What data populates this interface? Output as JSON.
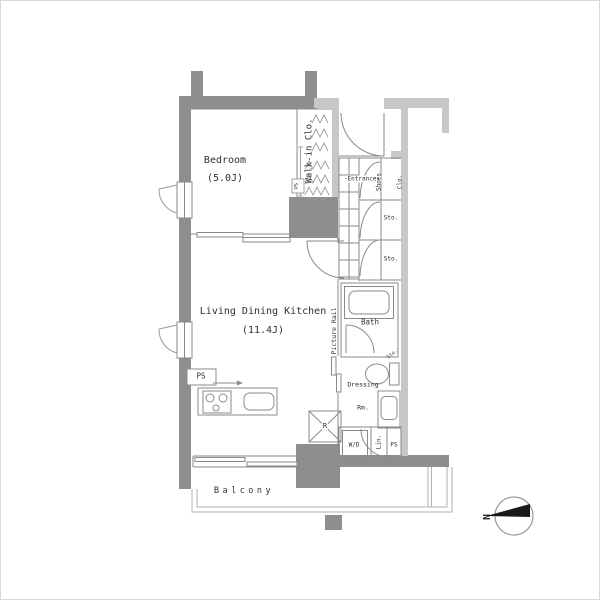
{
  "colors": {
    "wall_dark": "#8e8e8e",
    "wall_light": "#c7c7c7",
    "line": "#8a8a8a",
    "line_light": "#b2b2b2",
    "text": "#2f2f2f",
    "compass": "#1a1a1a"
  },
  "rooms": {
    "bedroom": {
      "name": "Bedroom",
      "size": "(5.0J)"
    },
    "ldk": {
      "name": "Living Dining Kitchen",
      "size": "(11.4J)"
    },
    "bath": {
      "name": "Bath"
    },
    "entrance": {
      "name": "-Entrance-"
    },
    "balcony": {
      "name": "Balcony"
    },
    "dressing": {
      "line1": "Dressing",
      "line2": "Rm."
    },
    "walkin_closet": {
      "name": "Walk-in Clo."
    },
    "shoes_closet": {
      "line1": "Shoes",
      "line2": "Clo."
    }
  },
  "fixtures": {
    "storage_upper": "Sto.",
    "storage_lower": "Sto.",
    "storage_toilet": "Sto.",
    "washer_dryer": "W/D",
    "linen": "Lin.",
    "pipe_space_dressing": "PS",
    "pipe_space_kitchen": "PS",
    "pipe_space_walkin": "PS",
    "refrigerator": "R",
    "picture_rail": "Picture Rail"
  },
  "compass": {
    "north": "N"
  }
}
